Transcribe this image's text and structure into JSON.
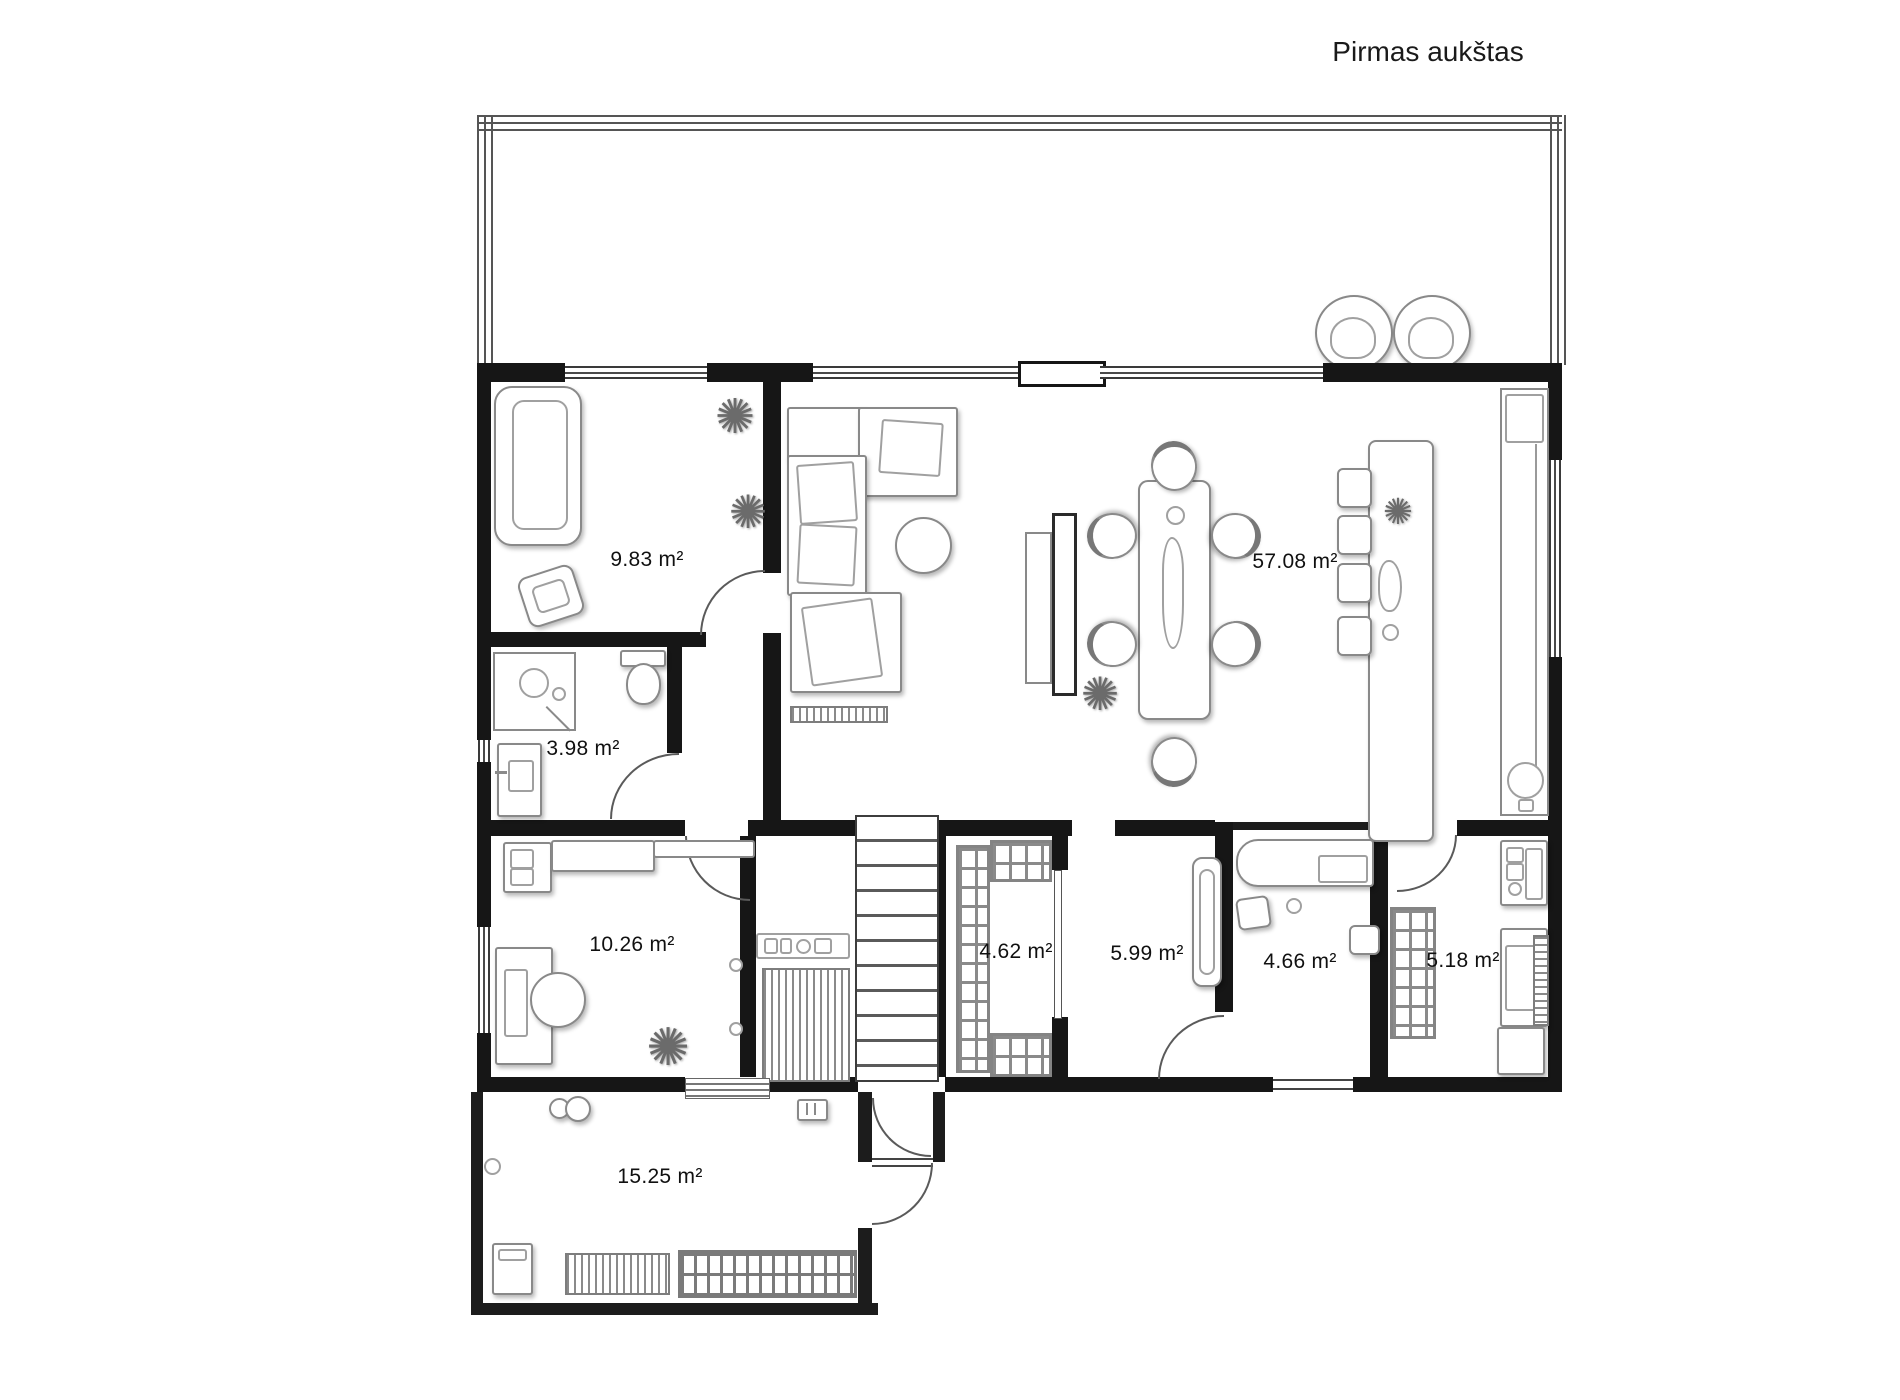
{
  "title": "Pirmas aukštas",
  "rooms": [
    {
      "name": "bedroom",
      "area": "9.83 m²"
    },
    {
      "name": "living-dining-kitchen",
      "area": "57.08 m²"
    },
    {
      "name": "bathroom",
      "area": "3.98 m²"
    },
    {
      "name": "office",
      "area": "10.26 m²"
    },
    {
      "name": "storage",
      "area": "4.62 m²"
    },
    {
      "name": "hallway",
      "area": "5.99 m²"
    },
    {
      "name": "utility-room",
      "area": "4.66 m²"
    },
    {
      "name": "pantry",
      "area": "5.18 m²"
    },
    {
      "name": "terrace-garage",
      "area": "15.25 m²"
    }
  ],
  "icons": {
    "plant": "✺"
  },
  "colors": {
    "wall": "#161616",
    "furniture_line": "#8a8a8a",
    "door_arc": "#5a5a5a",
    "background": "#ffffff",
    "text": "#111111"
  }
}
